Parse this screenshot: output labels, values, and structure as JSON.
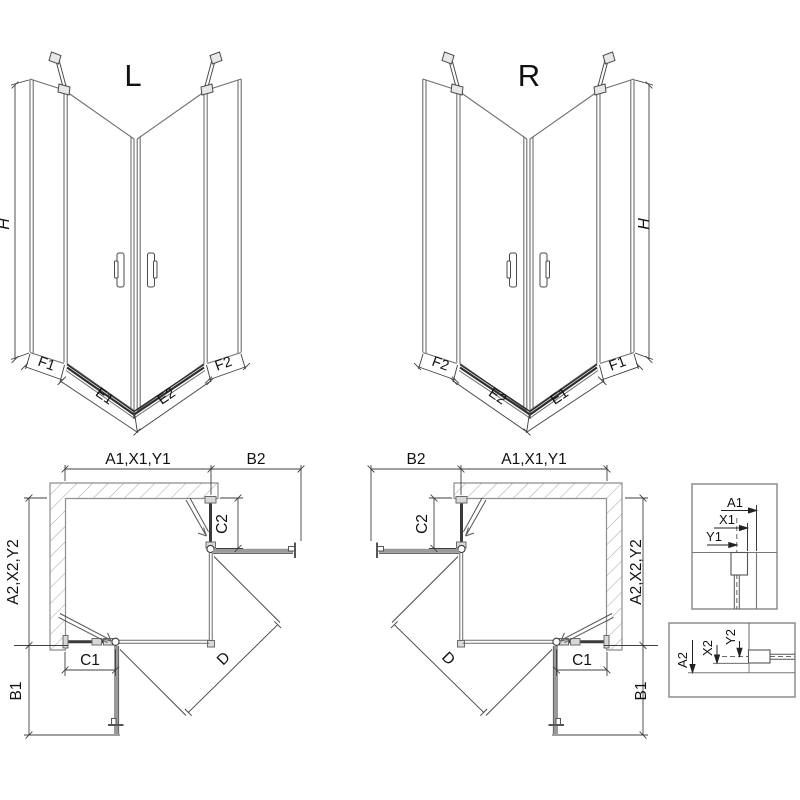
{
  "drawing_title": "Corner shower enclosure dimensional diagram",
  "views": {
    "left_3d": {
      "title": "L",
      "height_label": "H",
      "f1": "F1",
      "e1": "E1",
      "e2": "E2",
      "f2": "F2"
    },
    "right_3d": {
      "title": "R",
      "height_label": "H",
      "f1": "F1",
      "e1": "E1",
      "e2": "E2",
      "f2": "F2"
    },
    "left_plan": {
      "width_label": "A1,X1,Y1",
      "side_top_label": "B2",
      "depth_label": "A2,X2,Y2",
      "side_bottom_label": "B1",
      "fixed_right_label": "C2",
      "fixed_bottom_label": "C1",
      "diagonal_label": "D"
    },
    "right_plan": {
      "width_label": "A1,X1,Y1",
      "side_top_label": "B2",
      "depth_label": "A2,X2,Y2",
      "side_bottom_label": "B1",
      "fixed_right_label": "C2",
      "fixed_bottom_label": "C1",
      "diagonal_label": "D"
    },
    "detail_wall_profile_top": {
      "a": "A1",
      "x": "X1",
      "y": "Y1"
    },
    "detail_wall_profile_side": {
      "a": "A2",
      "x": "X2",
      "y": "Y2"
    }
  },
  "colors": {
    "background": "#ffffff",
    "line_dark": "#3a3a3a",
    "line_medium": "#6a6a6a",
    "glass_line": "#707070",
    "wall_outline": "#8e8e8e",
    "hatch": "#a5a5a5",
    "open_door": "#9a9a9a",
    "text": "#111111"
  }
}
